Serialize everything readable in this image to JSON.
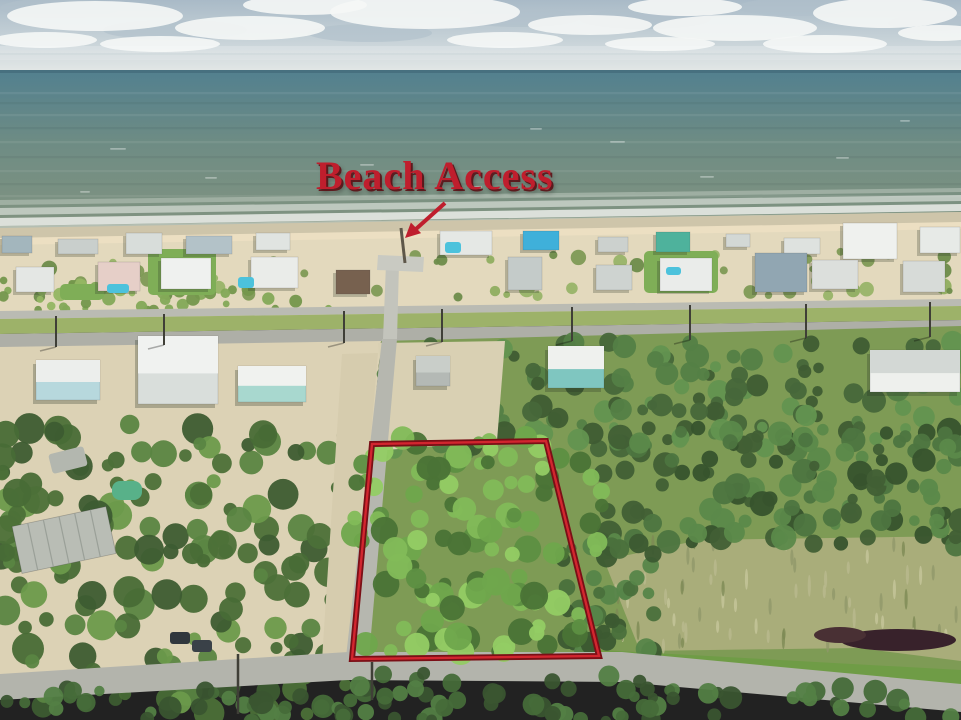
{
  "annotation": {
    "label": "Beach Access",
    "color": "#bf1e2d",
    "x": 316,
    "y": 156,
    "font_size": 40,
    "arrow": {
      "x1": 445,
      "y1": 203,
      "x2": 416,
      "y2": 229,
      "head": "405,238 410.9,222.5 421.1,233.1",
      "width": 4
    }
  },
  "parcel": {
    "points": "372,444 546,441 599,656 352,659",
    "stroke_outer": "#7a0f16",
    "stroke_inner": "#d2262f",
    "outer_width": 6,
    "inner_width": 2.4
  },
  "scene": {
    "size": {
      "w": 961,
      "h": 720
    },
    "sky": {
      "top": "#a9bac7",
      "mid": "#c9d4d9",
      "bottom": "#e8ebe9",
      "horizon_y": 72,
      "clouds": [
        [
          95,
          16,
          88,
          15
        ],
        [
          250,
          28,
          75,
          12
        ],
        [
          425,
          12,
          95,
          17
        ],
        [
          590,
          25,
          62,
          10
        ],
        [
          735,
          28,
          82,
          13
        ],
        [
          885,
          13,
          72,
          15
        ],
        [
          45,
          40,
          52,
          8
        ],
        [
          505,
          40,
          58,
          8
        ],
        [
          825,
          44,
          62,
          9
        ],
        [
          305,
          5,
          62,
          10
        ],
        [
          685,
          7,
          57,
          9
        ],
        [
          940,
          33,
          42,
          8
        ],
        [
          160,
          44,
          60,
          8
        ],
        [
          660,
          44,
          55,
          7
        ]
      ],
      "cloud_shadows": [
        [
          175,
          30,
          72,
          10
        ],
        [
          370,
          33,
          62,
          9
        ],
        [
          645,
          19,
          66,
          10
        ],
        [
          795,
          7,
          57,
          9
        ],
        [
          935,
          23,
          47,
          8
        ],
        [
          520,
          18,
          60,
          9
        ],
        [
          60,
          8,
          60,
          10
        ]
      ],
      "cloud_bands": [
        [
          0,
          46,
          961,
          7,
          0.2
        ],
        [
          0,
          55,
          961,
          5,
          0.14
        ]
      ]
    },
    "ocean": {
      "top": "#52808f",
      "mid": "#6e8c84",
      "bottom": "#839480",
      "y": 70,
      "h": 162,
      "horizon_line": "#47707f",
      "streak_ys": [
        92,
        102,
        114,
        127,
        141,
        156,
        170,
        183,
        195
      ],
      "streak_light": "rgba(255,255,255,0.07)",
      "streak_dark": "rgba(20,40,40,0.06)",
      "whitecaps": [
        [
          110,
          148,
          16
        ],
        [
          360,
          164,
          14
        ],
        [
          610,
          141,
          15
        ],
        [
          836,
          157,
          13
        ],
        [
          205,
          177,
          12
        ],
        [
          700,
          176,
          14
        ],
        [
          470,
          186,
          12
        ],
        [
          80,
          191,
          10
        ],
        [
          900,
          120,
          10
        ],
        [
          530,
          128,
          12
        ]
      ]
    },
    "foam": [
      {
        "pts": "0,200 961,188 961,192 0,205",
        "o": 0.3
      },
      {
        "pts": "0,208 961,195 961,201 0,215",
        "o": 0.55
      },
      {
        "pts": "0,218 961,204 961,211 0,226",
        "o": 0.8
      },
      {
        "pts": "0,226 961,212 961,215 0,230",
        "o": 0.45
      }
    ],
    "beach": {
      "wet": {
        "pts": "0,228 961,212 961,229 0,245",
        "fill": "#cec5aa"
      },
      "dry": {
        "pts": "0,243 961,227 961,311 0,322",
        "fill": "#e3d9bd"
      },
      "bright": {
        "pts": "0,238 961,222 961,229 0,245",
        "fill": "#ecdfc2"
      }
    },
    "lawns": [
      [
        148,
        249,
        68,
        46
      ],
      [
        644,
        251,
        74,
        42
      ],
      [
        60,
        284,
        44,
        16
      ],
      [
        540,
        344,
        74,
        52
      ]
    ],
    "houses_row1": [
      [
        2,
        236,
        30,
        17,
        "#a3b6bd"
      ],
      [
        58,
        239,
        40,
        15,
        "#c9cfcc"
      ],
      [
        126,
        233,
        36,
        21,
        "#d8ddda"
      ],
      [
        186,
        236,
        46,
        18,
        "#b3c2c8"
      ],
      [
        256,
        233,
        34,
        17,
        "#e0e4e1"
      ],
      [
        440,
        231,
        52,
        24,
        "#e5e8e5"
      ],
      [
        523,
        231,
        36,
        19,
        "#3fb0da"
      ],
      [
        598,
        237,
        30,
        15,
        "#ccd1ce"
      ],
      [
        656,
        232,
        34,
        20,
        "#4eb29c"
      ],
      [
        726,
        234,
        24,
        13,
        "#d3d8d5"
      ],
      [
        784,
        238,
        36,
        16,
        "#dee2df"
      ],
      [
        843,
        223,
        54,
        36,
        "#eff1ee"
      ],
      [
        920,
        227,
        40,
        26,
        "#e7eae7"
      ]
    ],
    "houses_row2": [
      [
        16,
        267,
        38,
        25,
        "#e4e7e4"
      ],
      [
        98,
        262,
        42,
        29,
        "#e6cfc8"
      ],
      [
        161,
        258,
        50,
        31,
        "#eff1ef"
      ],
      [
        251,
        257,
        47,
        31,
        "#eaece9"
      ],
      [
        336,
        270,
        34,
        24,
        "#77614f"
      ],
      [
        508,
        257,
        34,
        33,
        "#c4cbc9"
      ],
      [
        596,
        265,
        36,
        25,
        "#ced3d0"
      ],
      [
        660,
        258,
        52,
        33,
        "#eaecea"
      ],
      [
        755,
        253,
        52,
        39,
        "#91a6b2"
      ],
      [
        812,
        260,
        46,
        29,
        "#dcdfdc"
      ],
      [
        903,
        261,
        42,
        31,
        "#d7dbd8"
      ]
    ],
    "pools": [
      [
        107,
        284,
        22,
        9
      ],
      [
        238,
        277,
        16,
        11
      ],
      [
        445,
        242,
        16,
        11
      ],
      [
        666,
        267,
        15,
        8
      ]
    ],
    "pool_color": "#4cc2dc",
    "roads_pre": [
      {
        "name": "beach-street",
        "pts": "0,311 961,299 961,306 0,319",
        "fill": "#babbb3"
      },
      {
        "name": "mid-grass-strip",
        "pts": "0,319 961,306 961,320 0,334",
        "fill": "#9db269"
      },
      {
        "name": "main-road",
        "pts": "0,334 961,320 961,334 0,348",
        "fill": "#aeafa7"
      }
    ],
    "bases": [
      {
        "name": "left-ground",
        "pts": "0,347 381,341 352,661 0,676",
        "fill": "#dcd2b5"
      },
      {
        "name": "right-ground",
        "pts": "381,341 961,326 961,690 352,661",
        "fill": "#7e9b55"
      }
    ],
    "marsh": {
      "pts": "604,560 700,540 961,536 961,661 858,648 640,651",
      "fill": "#a9ad7a",
      "texture": {
        "x": 612,
        "y": 542,
        "w": 345,
        "h": 105,
        "n": 70,
        "seed": 77,
        "colors": [
          "#c6c59b",
          "#90976a",
          "#b9b98f",
          "#7d8a55"
        ]
      },
      "mud": [
        [
          898,
          640,
          58,
          11,
          "#38222b"
        ],
        [
          840,
          635,
          26,
          8,
          "#493034"
        ]
      ]
    },
    "roadside_grass": {
      "pts": "600,650 961,670 961,686 600,663",
      "fill": "#6f9c46"
    },
    "clearing": {
      "pts": "378,343 505,341 497,441 386,450",
      "fill": "#d9d0b3"
    },
    "clusters": [
      {
        "name": "dune-scrub",
        "x": 0,
        "y": 250,
        "w": 961,
        "h": 48,
        "n": 60,
        "rmin": 3,
        "rmax": 8,
        "seed": 11,
        "colors": [
          "#7e9a55",
          "#8fae60",
          "#6d8c4a",
          "#98b468"
        ]
      },
      {
        "name": "left-dune-grass",
        "x": 0,
        "y": 280,
        "w": 340,
        "h": 30,
        "n": 45,
        "rmin": 3,
        "rmax": 7,
        "seed": 21,
        "colors": [
          "#83a957",
          "#93b662",
          "#74974c"
        ]
      }
    ],
    "forest": [
      {
        "name": "forest-top",
        "x": 375,
        "y": 342,
        "w": 586,
        "h": 110,
        "n": 150,
        "rmin": 5,
        "rmax": 12,
        "seed": 31,
        "colors": [
          "#47673a",
          "#548046",
          "#639450",
          "#3f5c33"
        ]
      },
      {
        "name": "forest-right",
        "x": 600,
        "y": 428,
        "w": 361,
        "h": 118,
        "n": 130,
        "rmin": 5,
        "rmax": 13,
        "seed": 41,
        "colors": [
          "#415f35",
          "#4d7540",
          "#5b894a",
          "#37532d"
        ]
      },
      {
        "name": "forest-edge",
        "x": 560,
        "y": 540,
        "w": 95,
        "h": 112,
        "n": 40,
        "rmin": 5,
        "rmax": 11,
        "seed": 51,
        "colors": [
          "#3c5a31",
          "#4a703c",
          "#568549"
        ]
      },
      {
        "name": "left-tree-mass",
        "x": 0,
        "y": 424,
        "w": 352,
        "h": 292,
        "n": 170,
        "rmin": 6,
        "rmax": 16,
        "seed": 61,
        "colors": [
          "#3d5c31",
          "#4c7038",
          "#5a8542",
          "#6b9a4b",
          "#486c36"
        ]
      }
    ],
    "parcel_trees": {
      "name": "parcel-trees",
      "x": 354,
      "y": 436,
      "w": 248,
      "h": 222,
      "n": 110,
      "rmin": 6,
      "rmax": 14,
      "seed": 71,
      "colors": [
        "#5d8f42",
        "#6fa64c",
        "#82bb58",
        "#93cc64",
        "#4a7336"
      ]
    },
    "bottom_trees": [
      {
        "name": "bottom-tree-band",
        "x": 0,
        "y": 688,
        "w": 961,
        "h": 34,
        "n": 70,
        "rmin": 5,
        "rmax": 12,
        "seed": 81,
        "colors": [
          "#3a5530",
          "#466b39",
          "#538044"
        ]
      },
      {
        "name": "bottom-mid-trees",
        "x": 340,
        "y": 672,
        "w": 340,
        "h": 48,
        "n": 30,
        "rmin": 5,
        "rmax": 11,
        "seed": 91,
        "colors": [
          "#3a5530",
          "#466b39",
          "#538044"
        ]
      }
    ],
    "roads_post": [
      {
        "name": "street-shoulder",
        "pts": "342,354 378,353 352,660 322,660",
        "fill": "#d6ccae"
      },
      {
        "name": "vertical-street",
        "pts": "382,339 397,339 369,657 346,657",
        "fill": "#b6b7af"
      },
      {
        "name": "bottom-road",
        "pts": "0,674 348,652 622,652 961,684 961,712 622,682 348,680 0,700",
        "fill": "#b3b4ac"
      },
      {
        "name": "access-stub",
        "pts": "386,264 399,264 397,339 383,339",
        "fill": "#c3c4bc"
      },
      {
        "name": "parking-pad",
        "pts": "378,255 424,257 423,272 377,270",
        "fill": "#c9cac2"
      }
    ],
    "beach_path": {
      "x1": 401,
      "y1": 228,
      "x2": 405,
      "y2": 263,
      "color": "#5e5749",
      "w": 3
    },
    "houses_lower": [
      [
        36,
        360,
        64,
        40,
        "#eceeec",
        "#b7d8dd"
      ],
      [
        138,
        336,
        80,
        68,
        "#f0f2f0",
        "#d9dedb"
      ],
      [
        238,
        366,
        68,
        36,
        "#f0f2ef",
        "#a8d8cf"
      ],
      [
        416,
        356,
        34,
        30,
        "#c9cec9",
        "#b4b9b5"
      ],
      [
        548,
        346,
        56,
        42,
        "#eff1ee",
        "#7fc6c0"
      ],
      [
        870,
        350,
        90,
        42,
        "#d3d8d5",
        "#eef0ed"
      ]
    ],
    "building": {
      "x": 16,
      "y": 516,
      "w": 96,
      "h": 48,
      "fill": "#b9bdb5",
      "stripe": "#9aa098",
      "rot": -12
    },
    "rv": {
      "x": 50,
      "y": 450,
      "w": 36,
      "h": 20,
      "fill": "#b3b7af",
      "rot": -14
    },
    "green_pool": {
      "x": 112,
      "y": 481,
      "w": 30,
      "h": 19,
      "fill": "#58b189"
    },
    "cars": [
      [
        170,
        632,
        20,
        12,
        "#30373d"
      ],
      [
        192,
        640,
        20,
        12,
        "#3a4148"
      ]
    ],
    "poles": [
      [
        56,
        316,
        347
      ],
      [
        164,
        314,
        345
      ],
      [
        344,
        311,
        343
      ],
      [
        442,
        309,
        342
      ],
      [
        572,
        307,
        341
      ],
      [
        690,
        305,
        340
      ],
      [
        806,
        304,
        338
      ],
      [
        930,
        302,
        337
      ]
    ],
    "bottom_poles": [
      [
        238,
        654,
        714
      ],
      [
        372,
        662,
        700
      ]
    ],
    "pole_color": "#3f3f37"
  }
}
